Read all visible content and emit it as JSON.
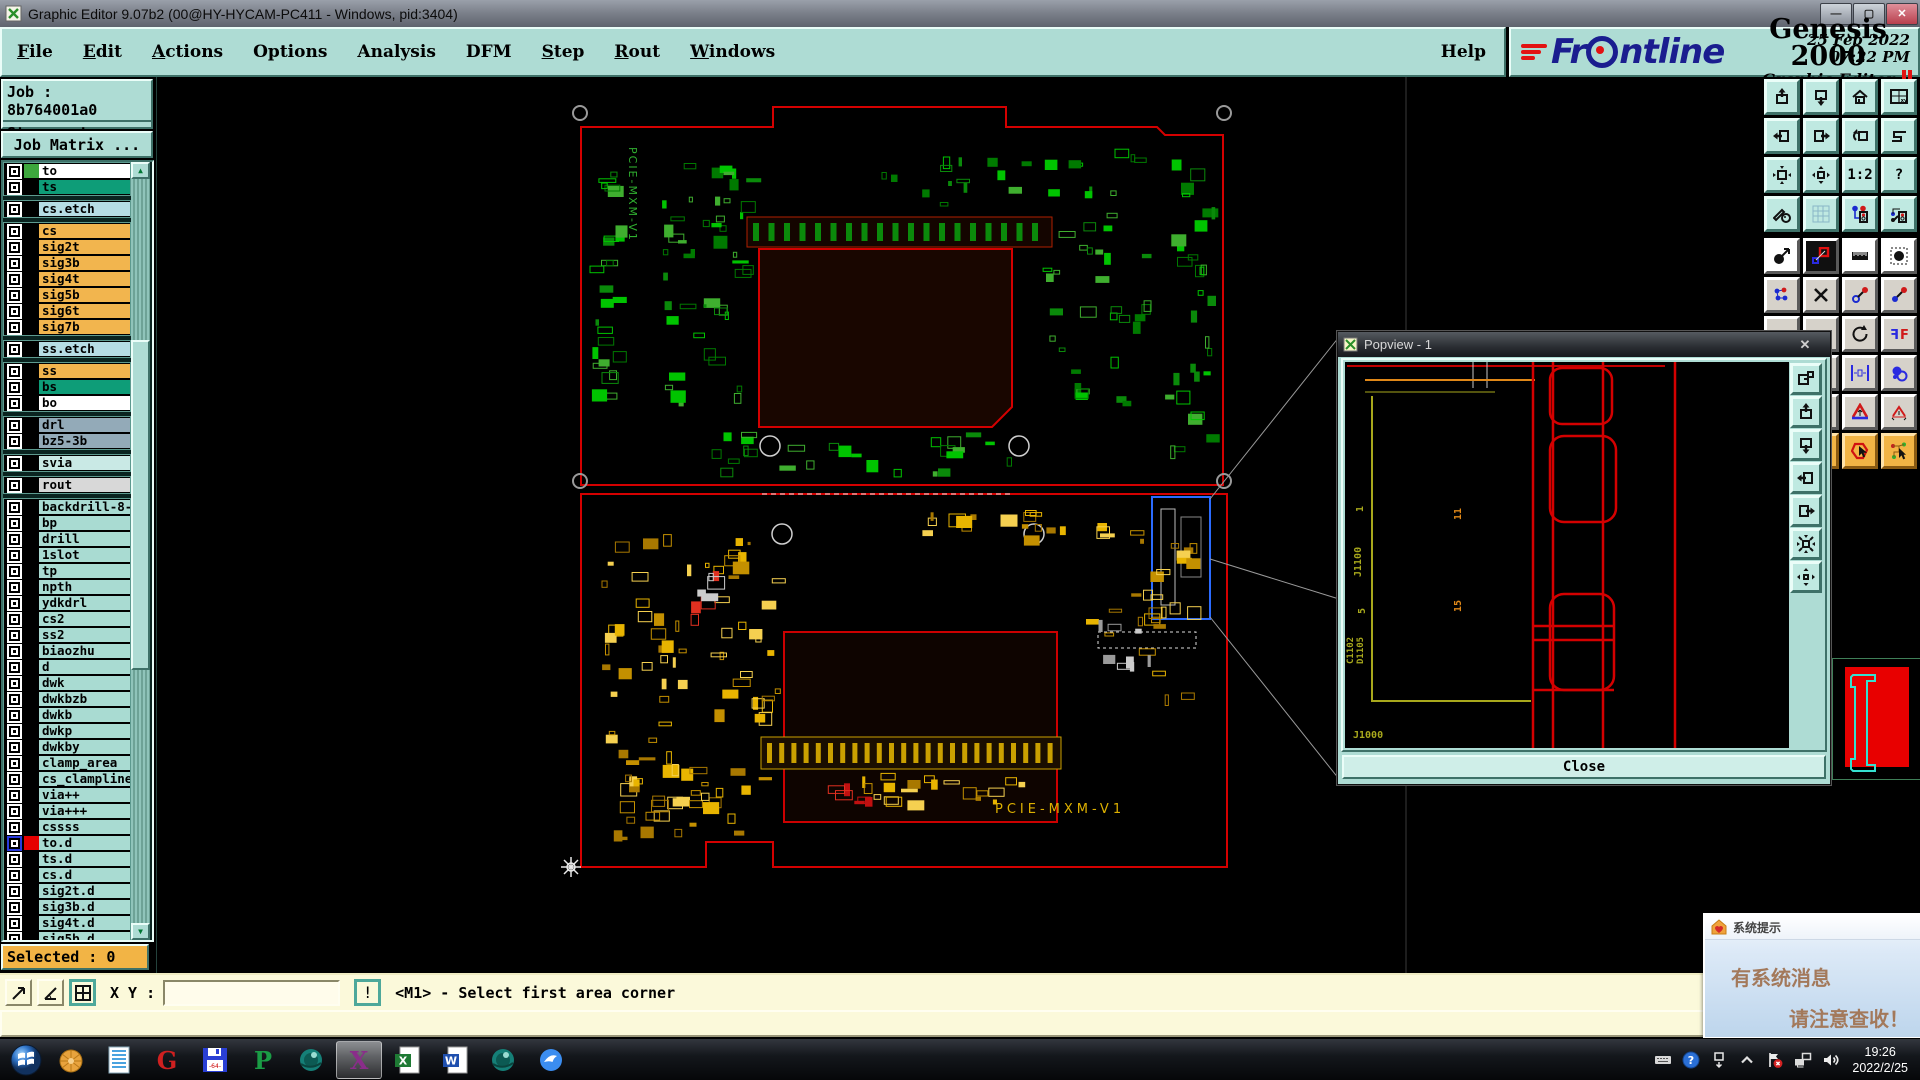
{
  "window": {
    "title": "Graphic Editor 9.07b2 (00@HY-HYCAM-PC411 - Windows, pid:3404)"
  },
  "menubar": {
    "items": [
      {
        "label": "File",
        "underline": true
      },
      {
        "label": "Edit",
        "underline": true
      },
      {
        "label": "Actions",
        "underline": true
      },
      {
        "label": "Options",
        "underline": false
      },
      {
        "label": "Analysis",
        "underline": false
      },
      {
        "label": "DFM",
        "underline": false
      },
      {
        "label": "Step",
        "underline": true
      },
      {
        "label": "Rout",
        "underline": true
      },
      {
        "label": "Windows",
        "underline": true
      }
    ],
    "help_label": "Help"
  },
  "brand": {
    "logo_text": "Frontline",
    "product": "Genesis 2000",
    "edition": "Graphic Editor",
    "date": "25 Feb 2022",
    "time": "07:22 PM"
  },
  "sidebar": {
    "job_label": "Job : 8b764001a0",
    "step_label": "Step: set",
    "matrix_button": "Job Matrix ...",
    "selected_label": "Selected : 0",
    "layer_groups": [
      {
        "rows": [
          {
            "name": "to",
            "bg": "#ffffff",
            "swatch": "#3da73d"
          },
          {
            "name": "ts",
            "bg": "#0e9d78"
          }
        ]
      },
      {
        "rows": [
          {
            "name": "cs.etch",
            "bg": "#b6dde4"
          }
        ]
      },
      {
        "rows": [
          {
            "name": "cs",
            "bg": "#f2b54e"
          },
          {
            "name": "sig2t",
            "bg": "#f2b54e"
          },
          {
            "name": "sig3b",
            "bg": "#f2b54e"
          },
          {
            "name": "sig4t",
            "bg": "#f2b54e"
          },
          {
            "name": "sig5b",
            "bg": "#f2b54e"
          },
          {
            "name": "sig6t",
            "bg": "#f2b54e"
          },
          {
            "name": "sig7b",
            "bg": "#f2b54e"
          }
        ]
      },
      {
        "rows": [
          {
            "name": "ss.etch",
            "bg": "#b6dde4"
          }
        ]
      },
      {
        "rows": [
          {
            "name": "ss",
            "bg": "#f2b54e"
          },
          {
            "name": "bs",
            "bg": "#0e9d78"
          },
          {
            "name": "bo",
            "bg": "#ffffff"
          }
        ]
      },
      {
        "rows": [
          {
            "name": "drl",
            "bg": "#93aab8"
          },
          {
            "name": "bz5-3b",
            "bg": "#93aab8"
          }
        ]
      },
      {
        "rows": [
          {
            "name": "svia",
            "bg": "#c9e9e5"
          }
        ]
      },
      {
        "rows": [
          {
            "name": "rout",
            "bg": "#d8d8d8"
          }
        ]
      },
      {
        "rows": [
          {
            "name": "backdrill-8-",
            "bg": "#a9dbd2"
          },
          {
            "name": "bp",
            "bg": "#a9dbd2"
          },
          {
            "name": "drill",
            "bg": "#a9dbd2"
          },
          {
            "name": "1slot",
            "bg": "#a9dbd2"
          },
          {
            "name": "tp",
            "bg": "#a9dbd2"
          },
          {
            "name": "npth",
            "bg": "#a9dbd2"
          },
          {
            "name": "ydkdrl",
            "bg": "#a9dbd2"
          },
          {
            "name": "cs2",
            "bg": "#a9dbd2"
          },
          {
            "name": "ss2",
            "bg": "#a9dbd2"
          },
          {
            "name": "biaozhu",
            "bg": "#a9dbd2"
          },
          {
            "name": "d",
            "bg": "#a9dbd2"
          },
          {
            "name": "dwk",
            "bg": "#a9dbd2"
          },
          {
            "name": "dwkbzb",
            "bg": "#a9dbd2"
          },
          {
            "name": "dwkb",
            "bg": "#a9dbd2"
          },
          {
            "name": "dwkp",
            "bg": "#a9dbd2"
          },
          {
            "name": "dwkby",
            "bg": "#a9dbd2"
          },
          {
            "name": "clamp_area",
            "bg": "#a9dbd2"
          },
          {
            "name": "cs_clampline",
            "bg": "#a9dbd2"
          },
          {
            "name": "via++",
            "bg": "#a9dbd2"
          },
          {
            "name": "via+++",
            "bg": "#a9dbd2"
          },
          {
            "name": "cssss",
            "bg": "#a9dbd2"
          },
          {
            "name": "to.d",
            "bg": "#a9dbd2",
            "swatch": "#e60000",
            "checkbox": "blue",
            "icons": "✎ ▦"
          },
          {
            "name": "ts.d",
            "bg": "#a9dbd2",
            "icons": "✎"
          },
          {
            "name": "cs.d",
            "bg": "#a9dbd2"
          },
          {
            "name": "sig2t.d",
            "bg": "#a9dbd2"
          },
          {
            "name": "sig3b.d",
            "bg": "#a9dbd2"
          },
          {
            "name": "sig4t.d",
            "bg": "#a9dbd2"
          },
          {
            "name": "sig5b.d",
            "bg": "#a9dbd2"
          }
        ]
      }
    ]
  },
  "statusbar": {
    "xy_label": "X Y :",
    "xy_value": "",
    "alert_label": "!",
    "prompt": "<M1> - Select first area corner"
  },
  "canvas": {
    "top_board_label": "PCIE-MXM-V1",
    "bottom_board_label": "PCIE-MXM-V1"
  },
  "popview": {
    "title": "Popview - 1",
    "close_label": "Close",
    "labels": {
      "pin1": "1",
      "ref_j1100": "J1100",
      "pin5": "5",
      "ref_c1102": "C1102",
      "ref_d1105": "D1105",
      "pin11": "11",
      "pin15": "15",
      "ref_j1000": "J1000"
    },
    "strip_icons": [
      "window-export",
      "pan-up",
      "pan-down",
      "pan-left",
      "pan-right",
      "zoom-contract",
      "zoom-expand"
    ]
  },
  "right_toolbar": {
    "teal_buttons": [
      {
        "name": "pan-up",
        "icon": "pan-up"
      },
      {
        "name": "pan-down",
        "icon": "pan-down"
      },
      {
        "name": "view-home",
        "icon": "home"
      },
      {
        "name": "view-window-xy",
        "icon": "winxy"
      },
      {
        "name": "pan-left",
        "icon": "pan-left"
      },
      {
        "name": "pan-right",
        "icon": "pan-right"
      },
      {
        "name": "view-back",
        "icon": "back"
      },
      {
        "name": "serpentine",
        "icon": "serp"
      },
      {
        "name": "zoom-in",
        "icon": "zin"
      },
      {
        "name": "zoom-out",
        "icon": "zout"
      },
      {
        "name": "scale-1-2",
        "label": "1:2"
      },
      {
        "name": "help-query",
        "label": "?"
      },
      {
        "name": "draw-tools",
        "icon": "tools"
      },
      {
        "name": "grid-toggle",
        "icon": "grid"
      },
      {
        "name": "net-colors-1",
        "icon": "net1",
        "style": "redbrd"
      },
      {
        "name": "net-colors-2",
        "icon": "net2",
        "style": "redbrd"
      }
    ],
    "gray_buttons": [
      {
        "name": "select-feature",
        "icon": "selc",
        "style": "white"
      },
      {
        "name": "shape-edit",
        "icon": "shed",
        "style": "dark"
      },
      {
        "name": "ruler-measure",
        "icon": "ruler",
        "style": "white"
      },
      {
        "name": "pad-select",
        "icon": "padsel",
        "style": "white"
      },
      {
        "name": "net-points",
        "icon": "netp"
      },
      {
        "name": "delete-feature",
        "icon": "delx"
      },
      {
        "name": "copy-point",
        "icon": "cpyp"
      },
      {
        "name": "move-point",
        "icon": "movp"
      },
      {
        "name": "tool-a1",
        "icon": ""
      },
      {
        "name": "tool-a2",
        "icon": ""
      },
      {
        "name": "rotate-feature",
        "icon": "rot"
      },
      {
        "name": "mirror-ff",
        "icon": "ff"
      },
      {
        "name": "tool-b1",
        "icon": ""
      },
      {
        "name": "tool-b2",
        "icon": ""
      },
      {
        "name": "measure-gap",
        "icon": "mgap"
      },
      {
        "name": "overlap-circles",
        "icon": "ovc"
      },
      {
        "name": "tool-c1",
        "icon": ""
      },
      {
        "name": "tool-c2",
        "icon": ""
      },
      {
        "name": "font-a-large",
        "icon": "ala"
      },
      {
        "name": "font-a-small",
        "icon": "alas"
      },
      {
        "name": "highlight-1",
        "icon": "hl1",
        "style": "orange"
      },
      {
        "name": "highlight-2",
        "icon": "hl1",
        "style": "orange"
      },
      {
        "name": "highlight-3",
        "icon": "hl1",
        "style": "orange"
      },
      {
        "name": "highlight-4",
        "icon": "hl2",
        "style": "orange"
      }
    ]
  },
  "notification": {
    "title": "系统提示",
    "line1": "有系统消息",
    "line2": "请注意查收！"
  },
  "taskbar": {
    "apps": [
      {
        "name": "shell-app",
        "kind": "shell"
      },
      {
        "name": "notes-app",
        "kind": "notes"
      },
      {
        "name": "genesis-launcher",
        "kind": "letter",
        "glyph": "G",
        "color": "#cf2020"
      },
      {
        "name": "backup-64",
        "kind": "floppy",
        "label": "64"
      },
      {
        "name": "paltalk-app",
        "kind": "letter",
        "glyph": "P",
        "color": "#1a9c45"
      },
      {
        "name": "cam-tool",
        "kind": "ball"
      },
      {
        "name": "exceed-x",
        "kind": "letter",
        "glyph": "X",
        "color": "#8a2d8a",
        "active": true
      },
      {
        "name": "excel",
        "kind": "doc",
        "glyph": "X",
        "color": "#1e7a34"
      },
      {
        "name": "word",
        "kind": "doc",
        "glyph": "W",
        "color": "#1f4fae"
      },
      {
        "name": "cam-tool-2",
        "kind": "ball"
      },
      {
        "name": "thunder-app",
        "kind": "bird"
      }
    ],
    "tray_icons": [
      "keyboard",
      "help",
      "window-flip",
      "chevron-up",
      "flag-alert",
      "network",
      "volume"
    ],
    "clock_time": "19:26",
    "clock_date": "2022/2/25"
  }
}
